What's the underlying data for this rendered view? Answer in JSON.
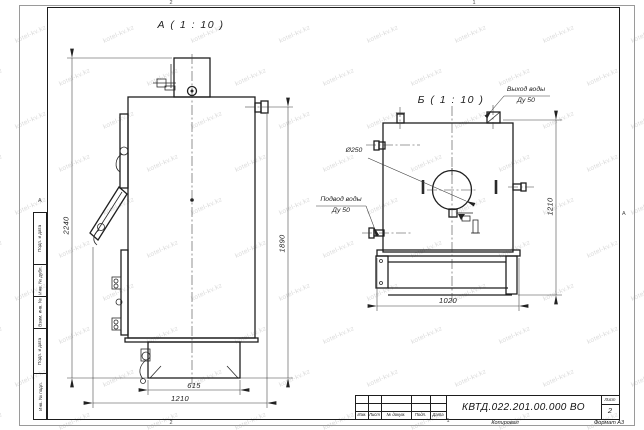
{
  "watermark": {
    "text": "kotel-kv.kz"
  },
  "views": {
    "a": {
      "label": "А ( 1 : 10 )"
    },
    "b": {
      "label": "Б ( 1 : 10 )"
    }
  },
  "callouts": {
    "flue_diameter": "Ø250",
    "water_outlet": {
      "line1": "Выход воды",
      "line2": "Ду 50"
    },
    "water_inlet": {
      "line1": "Подвод воды",
      "line2": "Ду 50"
    }
  },
  "dimensions": {
    "total_height": "2240",
    "outlet_height": "1890",
    "base_depth": "615",
    "body_depth": "1210",
    "rear_width": "1020",
    "rear_height": "1210"
  },
  "frame": {
    "zone_top_left": "2",
    "zone_top_right": "1",
    "zone_bottom_left": "2",
    "zone_bottom_right": "1",
    "zone_left": "А",
    "zone_right": "А",
    "side_column": [
      "Подп. и дата",
      "Инв. № дубл.",
      "Взам. инв. №",
      "Подп. и дата",
      "Инв. № подл."
    ]
  },
  "title_block": {
    "designation": "КВТД.022.201.00.000 ВО",
    "sheet_label": "Лист",
    "sheet_number": "2",
    "columns": [
      "Изм.",
      "Лист",
      "№ докум.",
      "Подп.",
      "Дата"
    ],
    "footer_copy": "Копировал",
    "footer_format": "Формат А3"
  }
}
